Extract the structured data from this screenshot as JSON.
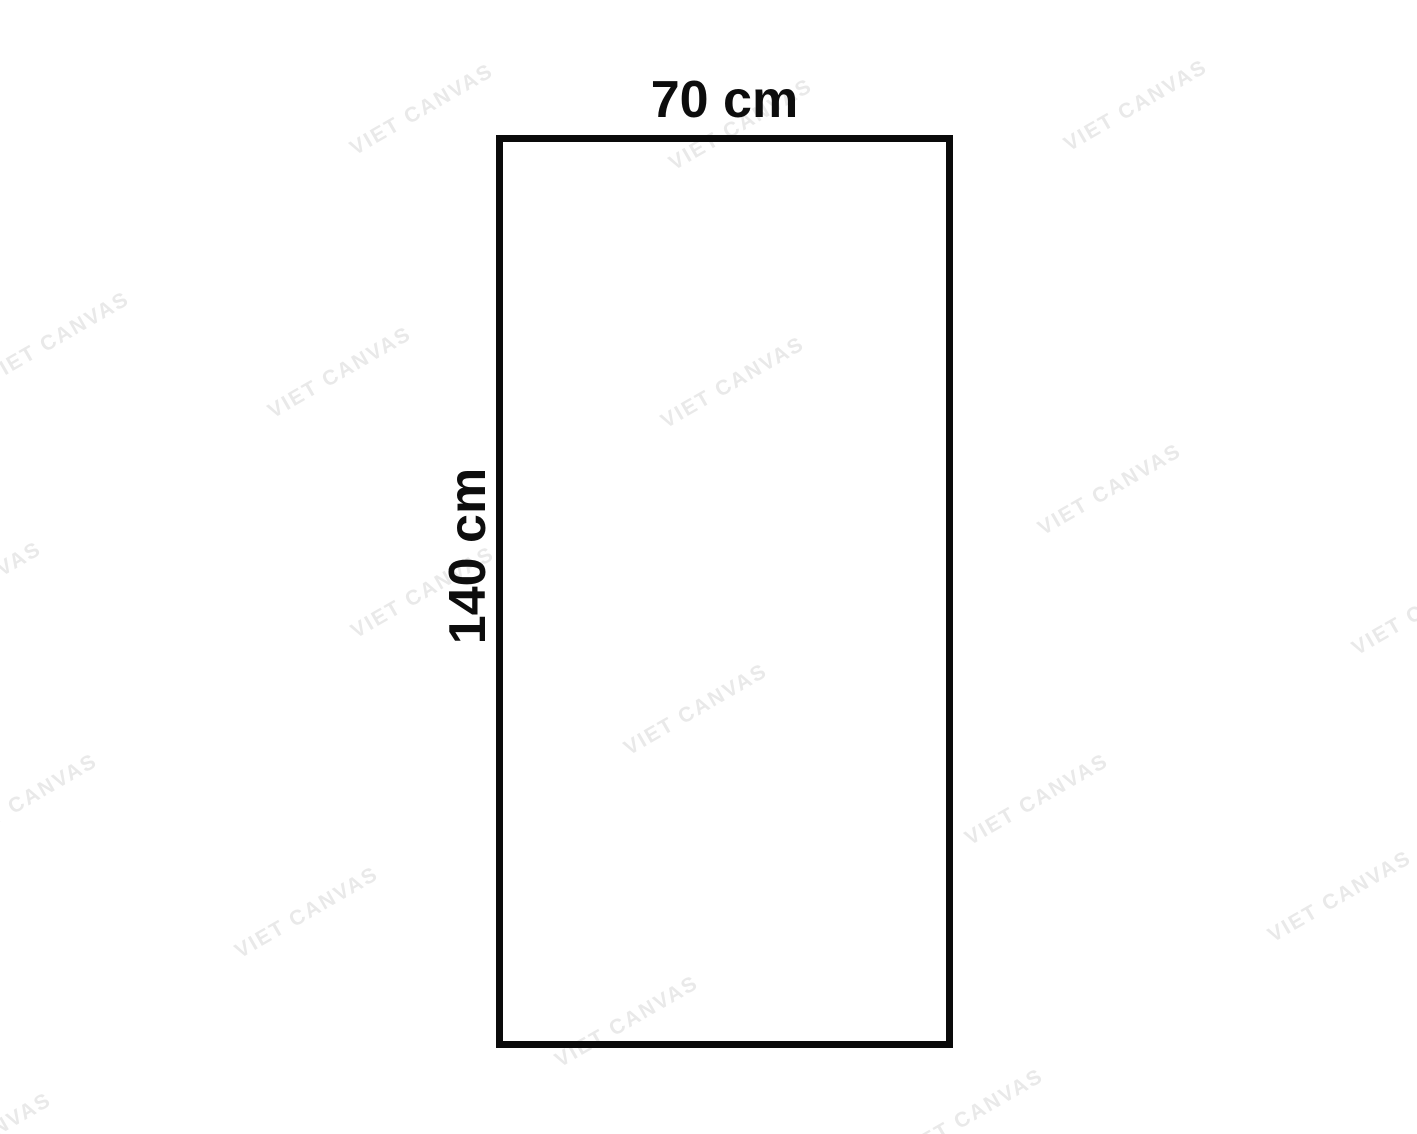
{
  "page": {
    "background_color": "#ffffff"
  },
  "diagram": {
    "type": "rectangle-dimension-outline",
    "outline_color": "#0a0a0a",
    "width_label": "70 cm",
    "height_label": "140 cm",
    "aspect_ratio": "70:140"
  },
  "watermark": {
    "text": "VIET CANVAS",
    "color": "#e9e9e9",
    "count": 18,
    "rotation_deg": -30
  }
}
